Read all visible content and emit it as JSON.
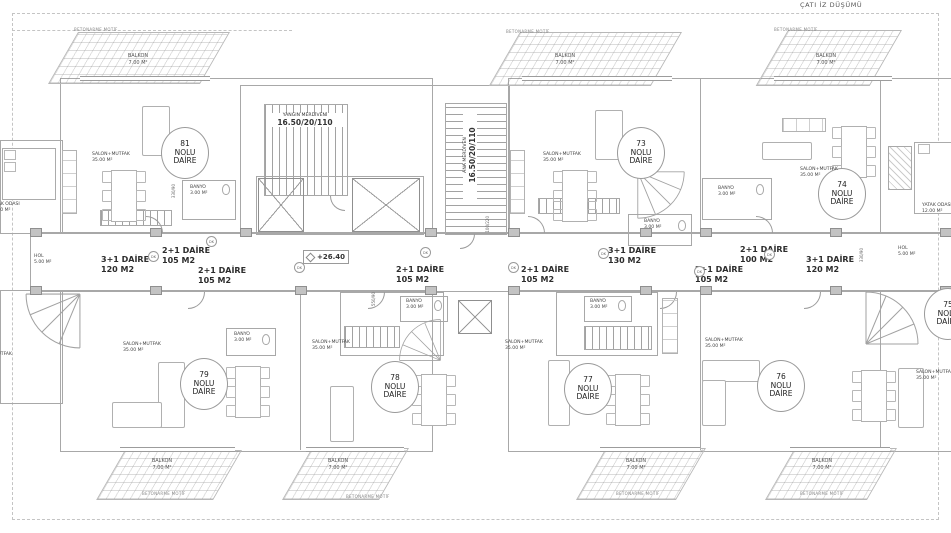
{
  "title": "ÇATI İZ DÜŞÜMÜ",
  "strings": {
    "balkon": "BALKON",
    "balkon_area": "7.00 M²",
    "motif": "BETONARME MOTİF",
    "nolu": "NOLU",
    "daire": "DAİRE",
    "dk": "DK"
  },
  "rooms": {
    "salon": {
      "name": "SALON+MUTFAK",
      "area": "35.00 M²"
    },
    "banyo": {
      "name": "BANYO",
      "area": "3.00 M²"
    },
    "hol": {
      "name": "HOL",
      "area": "5.00 M²"
    },
    "yatak": {
      "name": "YATAK ODASI",
      "area": "12.00 M²"
    }
  },
  "units": [
    {
      "no": "81"
    },
    {
      "no": "73"
    },
    {
      "no": "74"
    },
    {
      "no": "79"
    },
    {
      "no": "78"
    },
    {
      "no": "77"
    },
    {
      "no": "76"
    },
    {
      "no": "75"
    }
  ],
  "type_labels": [
    {
      "type": "3+1 DAİRE",
      "area": "120 M2"
    },
    {
      "type": "2+1 DAİRE",
      "area": "105 M2"
    },
    {
      "type": "2+1 DAİRE",
      "area": "105 M2"
    },
    {
      "type": "2+1 DAİRE",
      "area": "105 M2"
    },
    {
      "type": "2+1 DAİRE",
      "area": "105 M2"
    },
    {
      "type": "3+1 DAİRE",
      "area": "130 M2"
    },
    {
      "type": "2+1 DAİRE",
      "area": "105 M2"
    },
    {
      "type": "2+1 DAİRE",
      "area": "100 M2"
    },
    {
      "type": "3+1 DAİRE",
      "area": "120 M2"
    }
  ],
  "stairs": {
    "fire": {
      "name": "YANGIN MERDİVENİ",
      "dim": "16.50/20/110"
    },
    "main": {
      "name": "ANA MERDİVEN",
      "dim": "16.50/20/110"
    }
  },
  "elevation": "+26.40",
  "dims": [
    "550/90",
    "330/90",
    "330/90",
    "100/220"
  ],
  "colors": {
    "line": "#a8a8a8",
    "text": "#3a3a3a",
    "dash": "#c4c4c4"
  }
}
